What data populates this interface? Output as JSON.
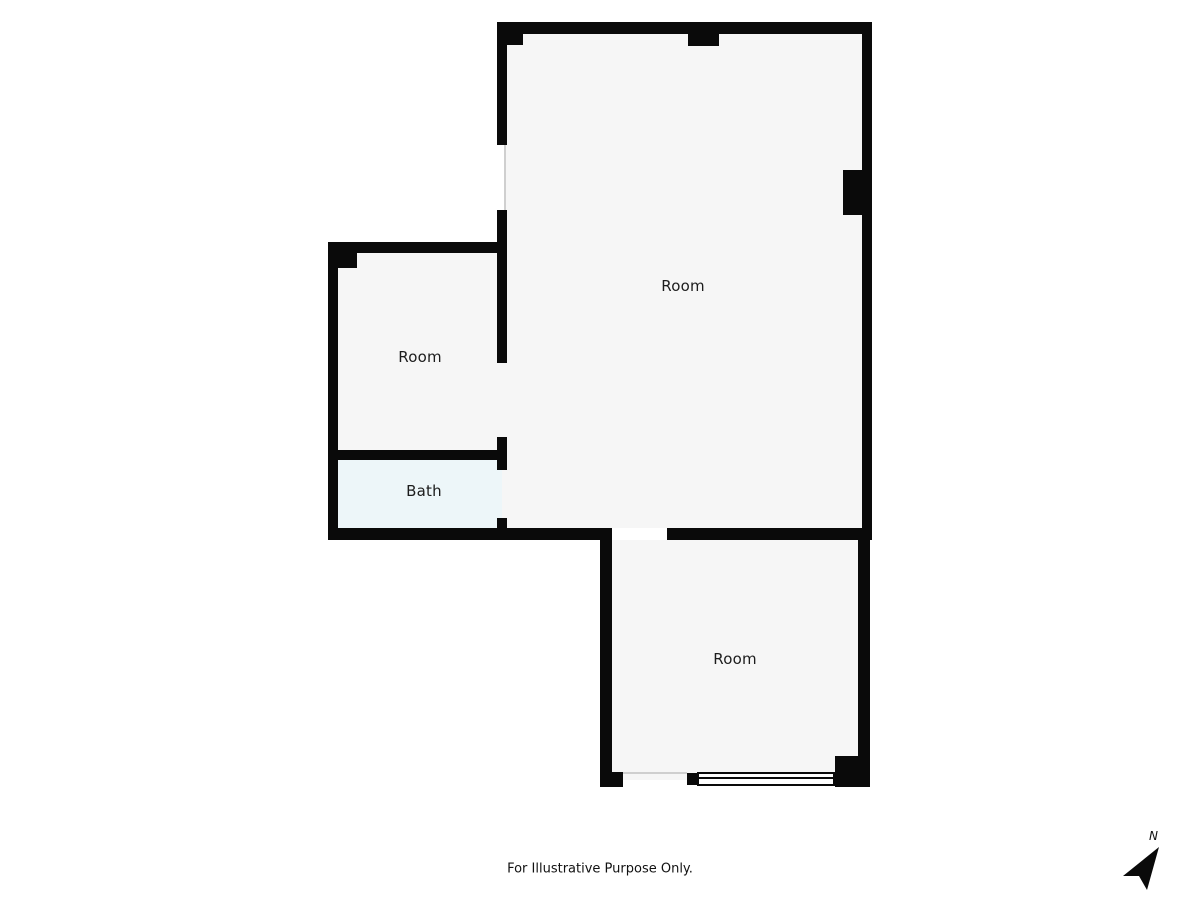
{
  "floorplan": {
    "rooms": [
      {
        "id": "room-large",
        "label": "Room"
      },
      {
        "id": "room-left",
        "label": "Room"
      },
      {
        "id": "bath",
        "label": "Bath"
      },
      {
        "id": "room-bottom",
        "label": "Room"
      }
    ],
    "disclaimer": "For Illustrative Purpose Only.",
    "compass_label": "N",
    "colors": {
      "wall": "#0a0a0a",
      "floor": "#f6f6f6",
      "bath_floor": "#edf6f9",
      "background": "#ffffff"
    }
  }
}
